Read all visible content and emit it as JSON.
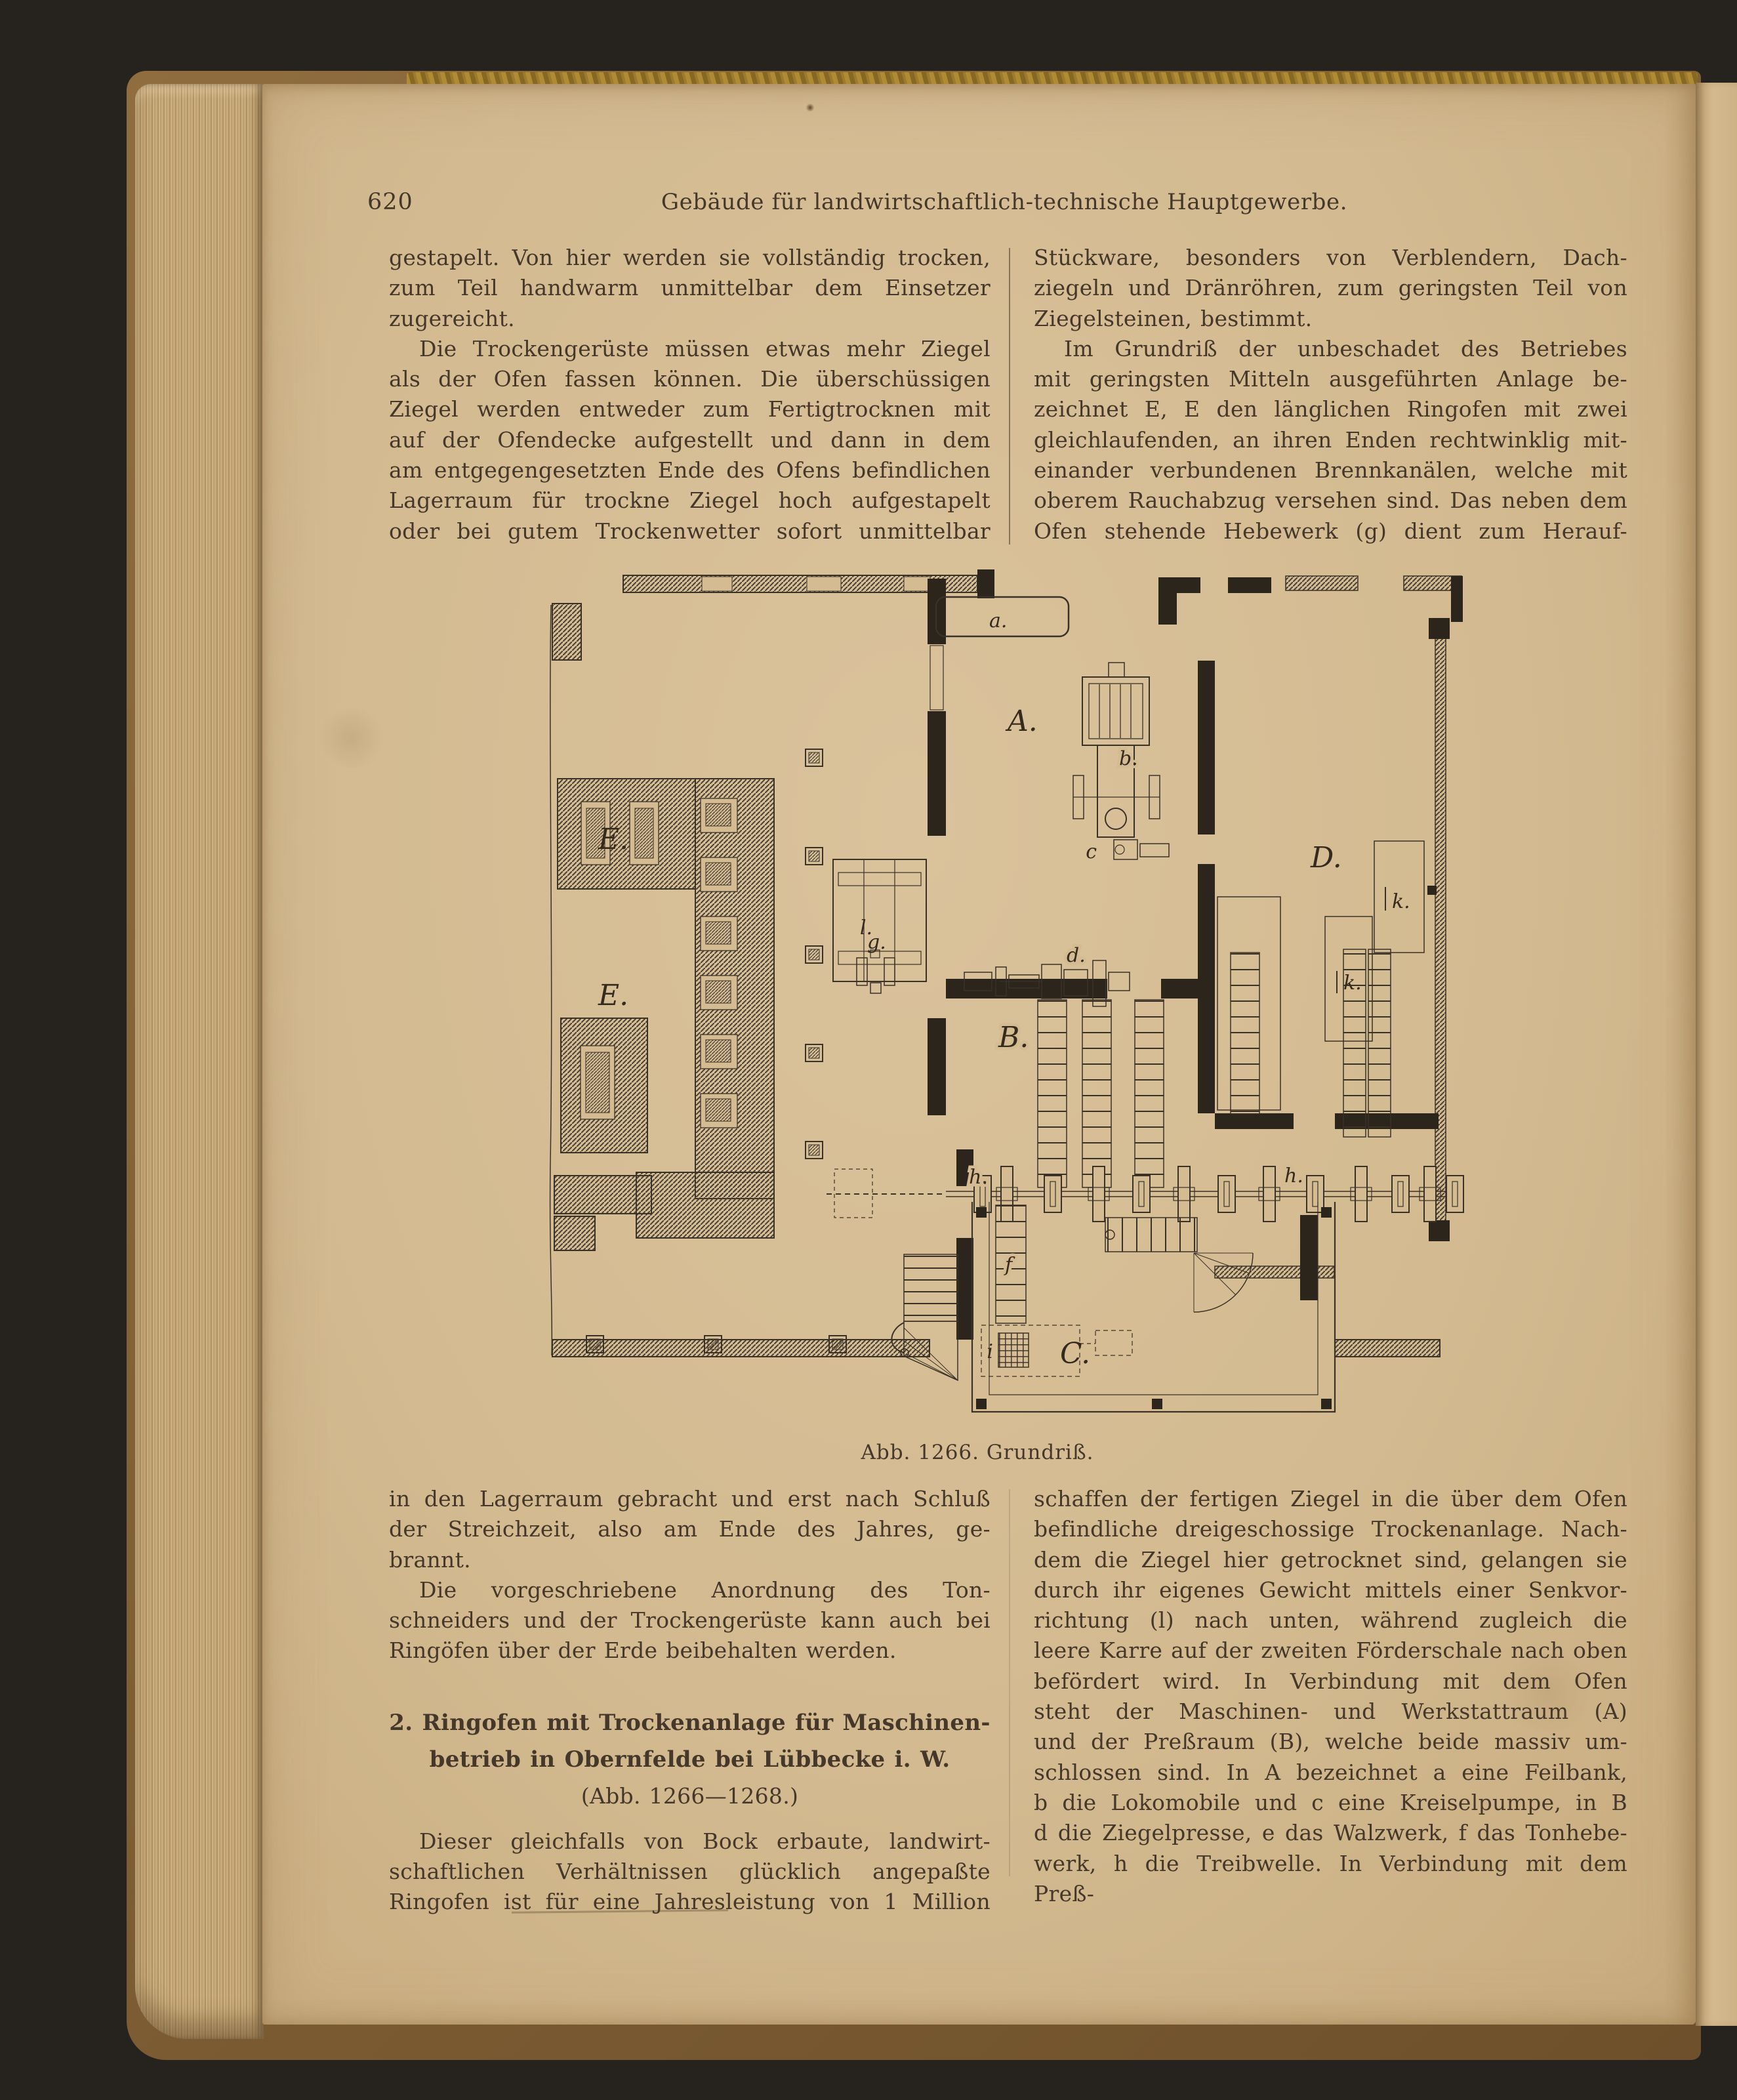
{
  "header": {
    "page_number": "620",
    "running_title": "Gebäude für landwirtschaftlich-technische Hauptgewerbe."
  },
  "top_left": {
    "lines": [
      {
        "t": "gestapelt.  Von hier werden sie vollständig trocken,"
      },
      {
        "t": "zum Teil handwarm unmittelbar dem Einsetzer"
      },
      {
        "t": "zugereicht.",
        "c": "nj"
      },
      {
        "t": "Die Trockengerüste müssen etwas mehr Ziegel",
        "c": "ind"
      },
      {
        "t": "als der Ofen fassen können.  Die überschüssigen"
      },
      {
        "t": "Ziegel werden entweder zum Fertigtrocknen mit"
      },
      {
        "t": "auf der Ofendecke aufgestellt und dann in dem"
      },
      {
        "t": "am entgegengesetzten Ende des Ofens befindlichen"
      },
      {
        "t": "Lagerraum für trockne Ziegel hoch aufgestapelt"
      },
      {
        "t": "oder bei gutem Trockenwetter sofort unmittelbar"
      }
    ]
  },
  "top_right": {
    "lines": [
      {
        "t": "Stückware,  besonders  von  Verblendern,  Dach-"
      },
      {
        "t": "ziegeln und Dränröhren, zum geringsten Teil von"
      },
      {
        "t": "Ziegelsteinen, bestimmt.",
        "c": "nj"
      },
      {
        "t": "Im Grundriß der unbeschadet des Betriebes",
        "c": "ind"
      },
      {
        "t": "mit geringsten Mitteln ausgeführten Anlage be-"
      },
      {
        "t": "zeichnet E, E den länglichen Ringofen mit zwei"
      },
      {
        "t": "gleichlaufenden, an ihren Enden rechtwinklig mit-"
      },
      {
        "t": "einander verbundenen Brennkanälen, welche mit"
      },
      {
        "t": "oberem Rauchabzug versehen sind.  Das neben dem"
      },
      {
        "t": "Ofen stehende Hebewerk (g) dient zum Herauf-"
      }
    ]
  },
  "bottom_left_p1": {
    "lines": [
      {
        "t": "in den Lagerraum gebracht und erst nach Schluß"
      },
      {
        "t": "der Streichzeit, also am Ende des Jahres, ge-"
      },
      {
        "t": "brannt.",
        "c": "nj"
      },
      {
        "t": "Die vorgeschriebene Anordnung des Ton-",
        "c": "ind"
      },
      {
        "t": "schneiders und der Trockengerüste kann auch bei"
      },
      {
        "t": "Ringöfen über der Erde beibehalten werden.",
        "c": "nj"
      }
    ]
  },
  "section_heading": {
    "lines": [
      {
        "t": "2. Ringofen mit Trockenanlage für Maschinen-",
        "c": "hb"
      },
      {
        "t": "betrieb in Obernfelde bei Lübbecke i. W.",
        "c": "hb"
      },
      {
        "t": "(Abb. 1266—1268.)",
        "c": "hr"
      }
    ]
  },
  "bottom_left_p2": {
    "lines": [
      {
        "t": "Dieser gleichfalls von Bock erbaute, landwirt-",
        "c": "ind"
      },
      {
        "t": "schaftlichen  Verhältnissen  glücklich  angepaßte"
      },
      {
        "t": "Ringofen ist für eine Jahresleistung von 1 Million"
      }
    ]
  },
  "bottom_right": {
    "lines": [
      {
        "t": "schaffen der fertigen Ziegel in die über dem Ofen"
      },
      {
        "t": "befindliche dreigeschossige Trockenanlage.  Nach-"
      },
      {
        "t": "dem die Ziegel hier getrocknet sind, gelangen sie"
      },
      {
        "t": "durch ihr eigenes Gewicht mittels einer Senkvor-"
      },
      {
        "t": "richtung (l) nach unten, während zugleich die"
      },
      {
        "t": "leere Karre auf der zweiten Förderschale nach oben"
      },
      {
        "t": "befördert wird.  In Verbindung mit dem Ofen"
      },
      {
        "t": "steht der Maschinen- und Werkstattraum (A)"
      },
      {
        "t": "und der Preßraum (B), welche beide massiv um-"
      },
      {
        "t": "schlossen sind.  In A bezeichnet a eine Feilbank,"
      },
      {
        "t": "b die Lokomobile und c eine Kreiselpumpe, in B"
      },
      {
        "t": "d die Ziegelpresse, e das Walzwerk, f das Tonhebe-"
      },
      {
        "t": "werk, h die Treibwelle.  In Verbindung mit dem Preß-"
      }
    ]
  },
  "figure": {
    "caption": "Abb. 1266.   Grundriß.",
    "labels": {
      "room_a": "A.",
      "room_b": "B.",
      "room_c": "C.",
      "room_d": "D.",
      "kiln_e_upper": "E.",
      "kiln_e_lower": "E.",
      "feilbank_a": "a.",
      "lokomobile_b": "b.",
      "kreiselpumpe_c": "c",
      "ziegelpresse_d": "d.",
      "hebewerk_g": "g.",
      "treibwelle_h_left": "h.",
      "treibwelle_h_right": "h.",
      "tonhebewerk_f": "f",
      "senkvorrichtung_l": "l.",
      "karre_i": "i",
      "k_right": "k.",
      "k_mid": "k."
    },
    "colors": {
      "paper": "#d3ba90",
      "ink": "#3a3127",
      "wall": "#2b251c"
    }
  }
}
